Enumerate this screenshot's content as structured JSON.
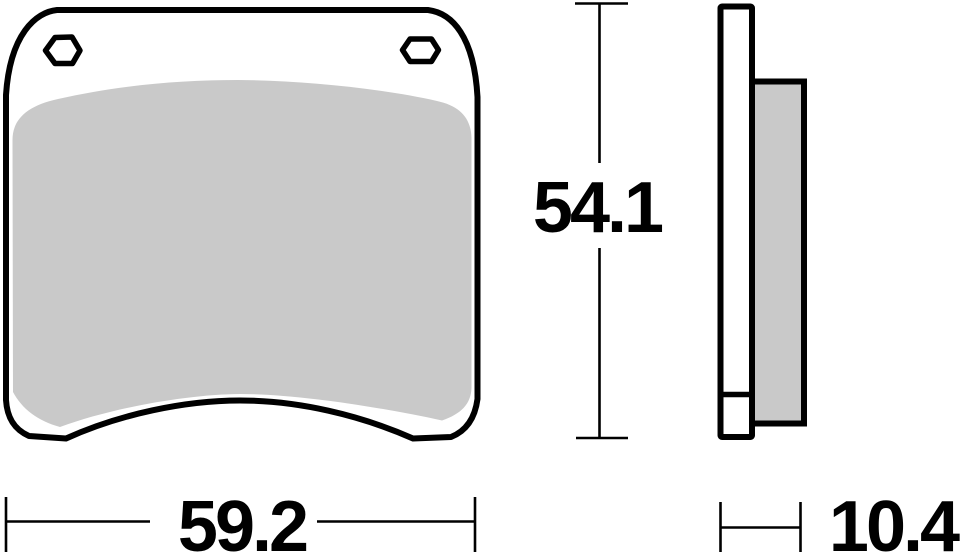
{
  "drawing": {
    "type": "technical-drawing",
    "subject": "brake-pad",
    "views": {
      "front": {
        "label": "front-view",
        "height_dim": {
          "value": "54.1",
          "orientation": "vertical"
        },
        "width_dim": {
          "value": "59.2",
          "orientation": "horizontal"
        }
      },
      "side": {
        "label": "side-view",
        "thickness_dim": {
          "value": "10.4",
          "orientation": "horizontal"
        }
      }
    },
    "colors": {
      "outline": "#000000",
      "friction_fill": "#c9c9c9",
      "plate_fill": "#ffffff",
      "background": "#ffffff"
    }
  }
}
